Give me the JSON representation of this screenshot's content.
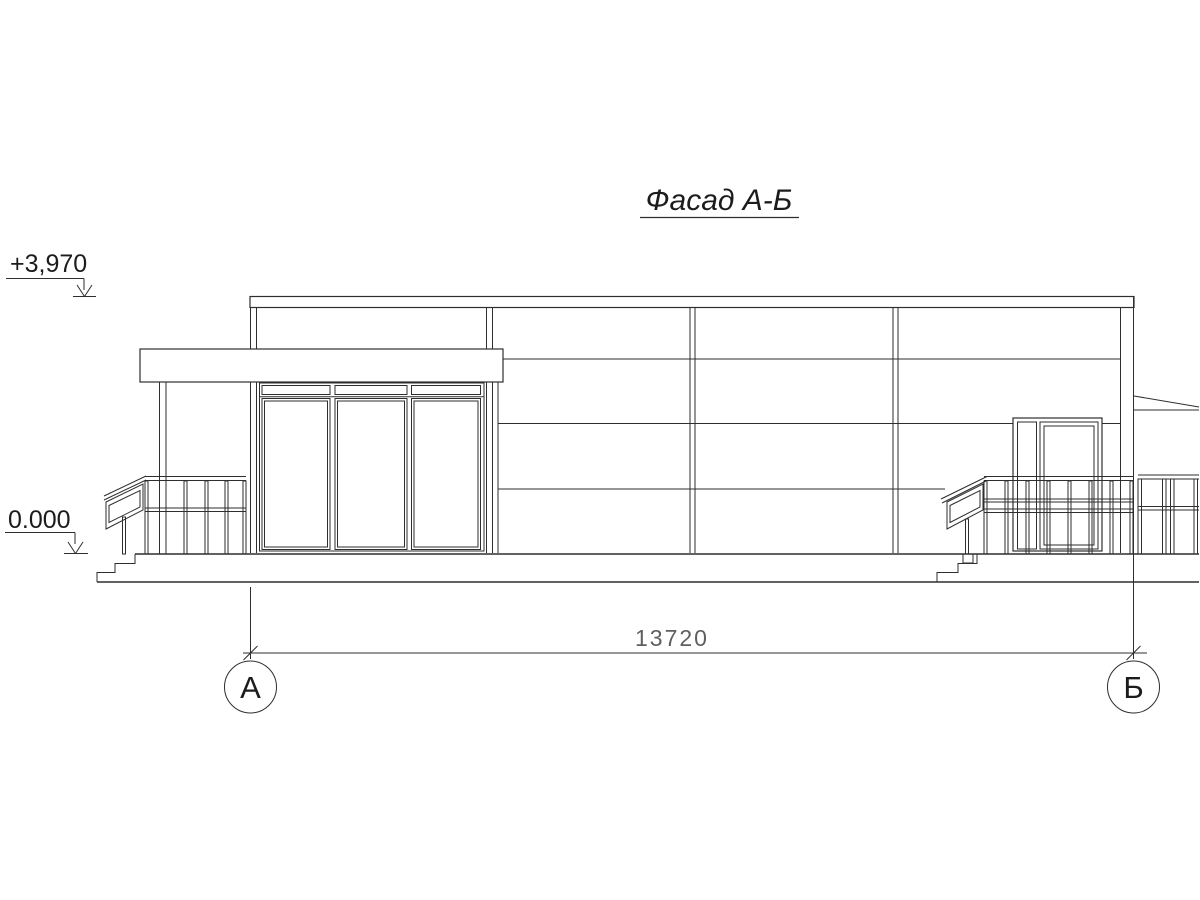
{
  "drawing": {
    "title": "Фасад А-Б",
    "elevation_marks": {
      "roof": "+3,970",
      "ground": "0.000"
    },
    "dimension": {
      "overall": "13720"
    },
    "axes": {
      "left": "А",
      "right": "Б"
    },
    "colors": {
      "background": "#ffffff",
      "line": "#2e2e2e",
      "dim-text": "#5f5f5f"
    }
  }
}
